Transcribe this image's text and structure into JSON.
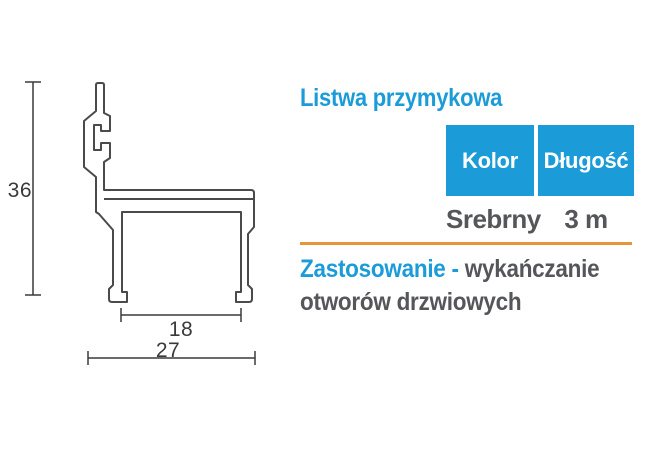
{
  "product": {
    "title": "Listwa przymykowa",
    "table": {
      "headers": [
        "Kolor",
        "Długość"
      ],
      "values": [
        "Srebrny",
        "3 m"
      ]
    },
    "application": {
      "label": "Zastosowanie -",
      "text": " wykańczanie otworów drzwiowych"
    }
  },
  "drawing": {
    "type": "profile-cross-section",
    "dimensions": {
      "height": "36",
      "inner_width": "18",
      "outer_width": "27"
    }
  },
  "colors": {
    "accent_blue": "#1b9bd8",
    "accent_orange": "#e6953a",
    "text_gray": "#55565a",
    "line_dark": "#3a3a3c"
  }
}
